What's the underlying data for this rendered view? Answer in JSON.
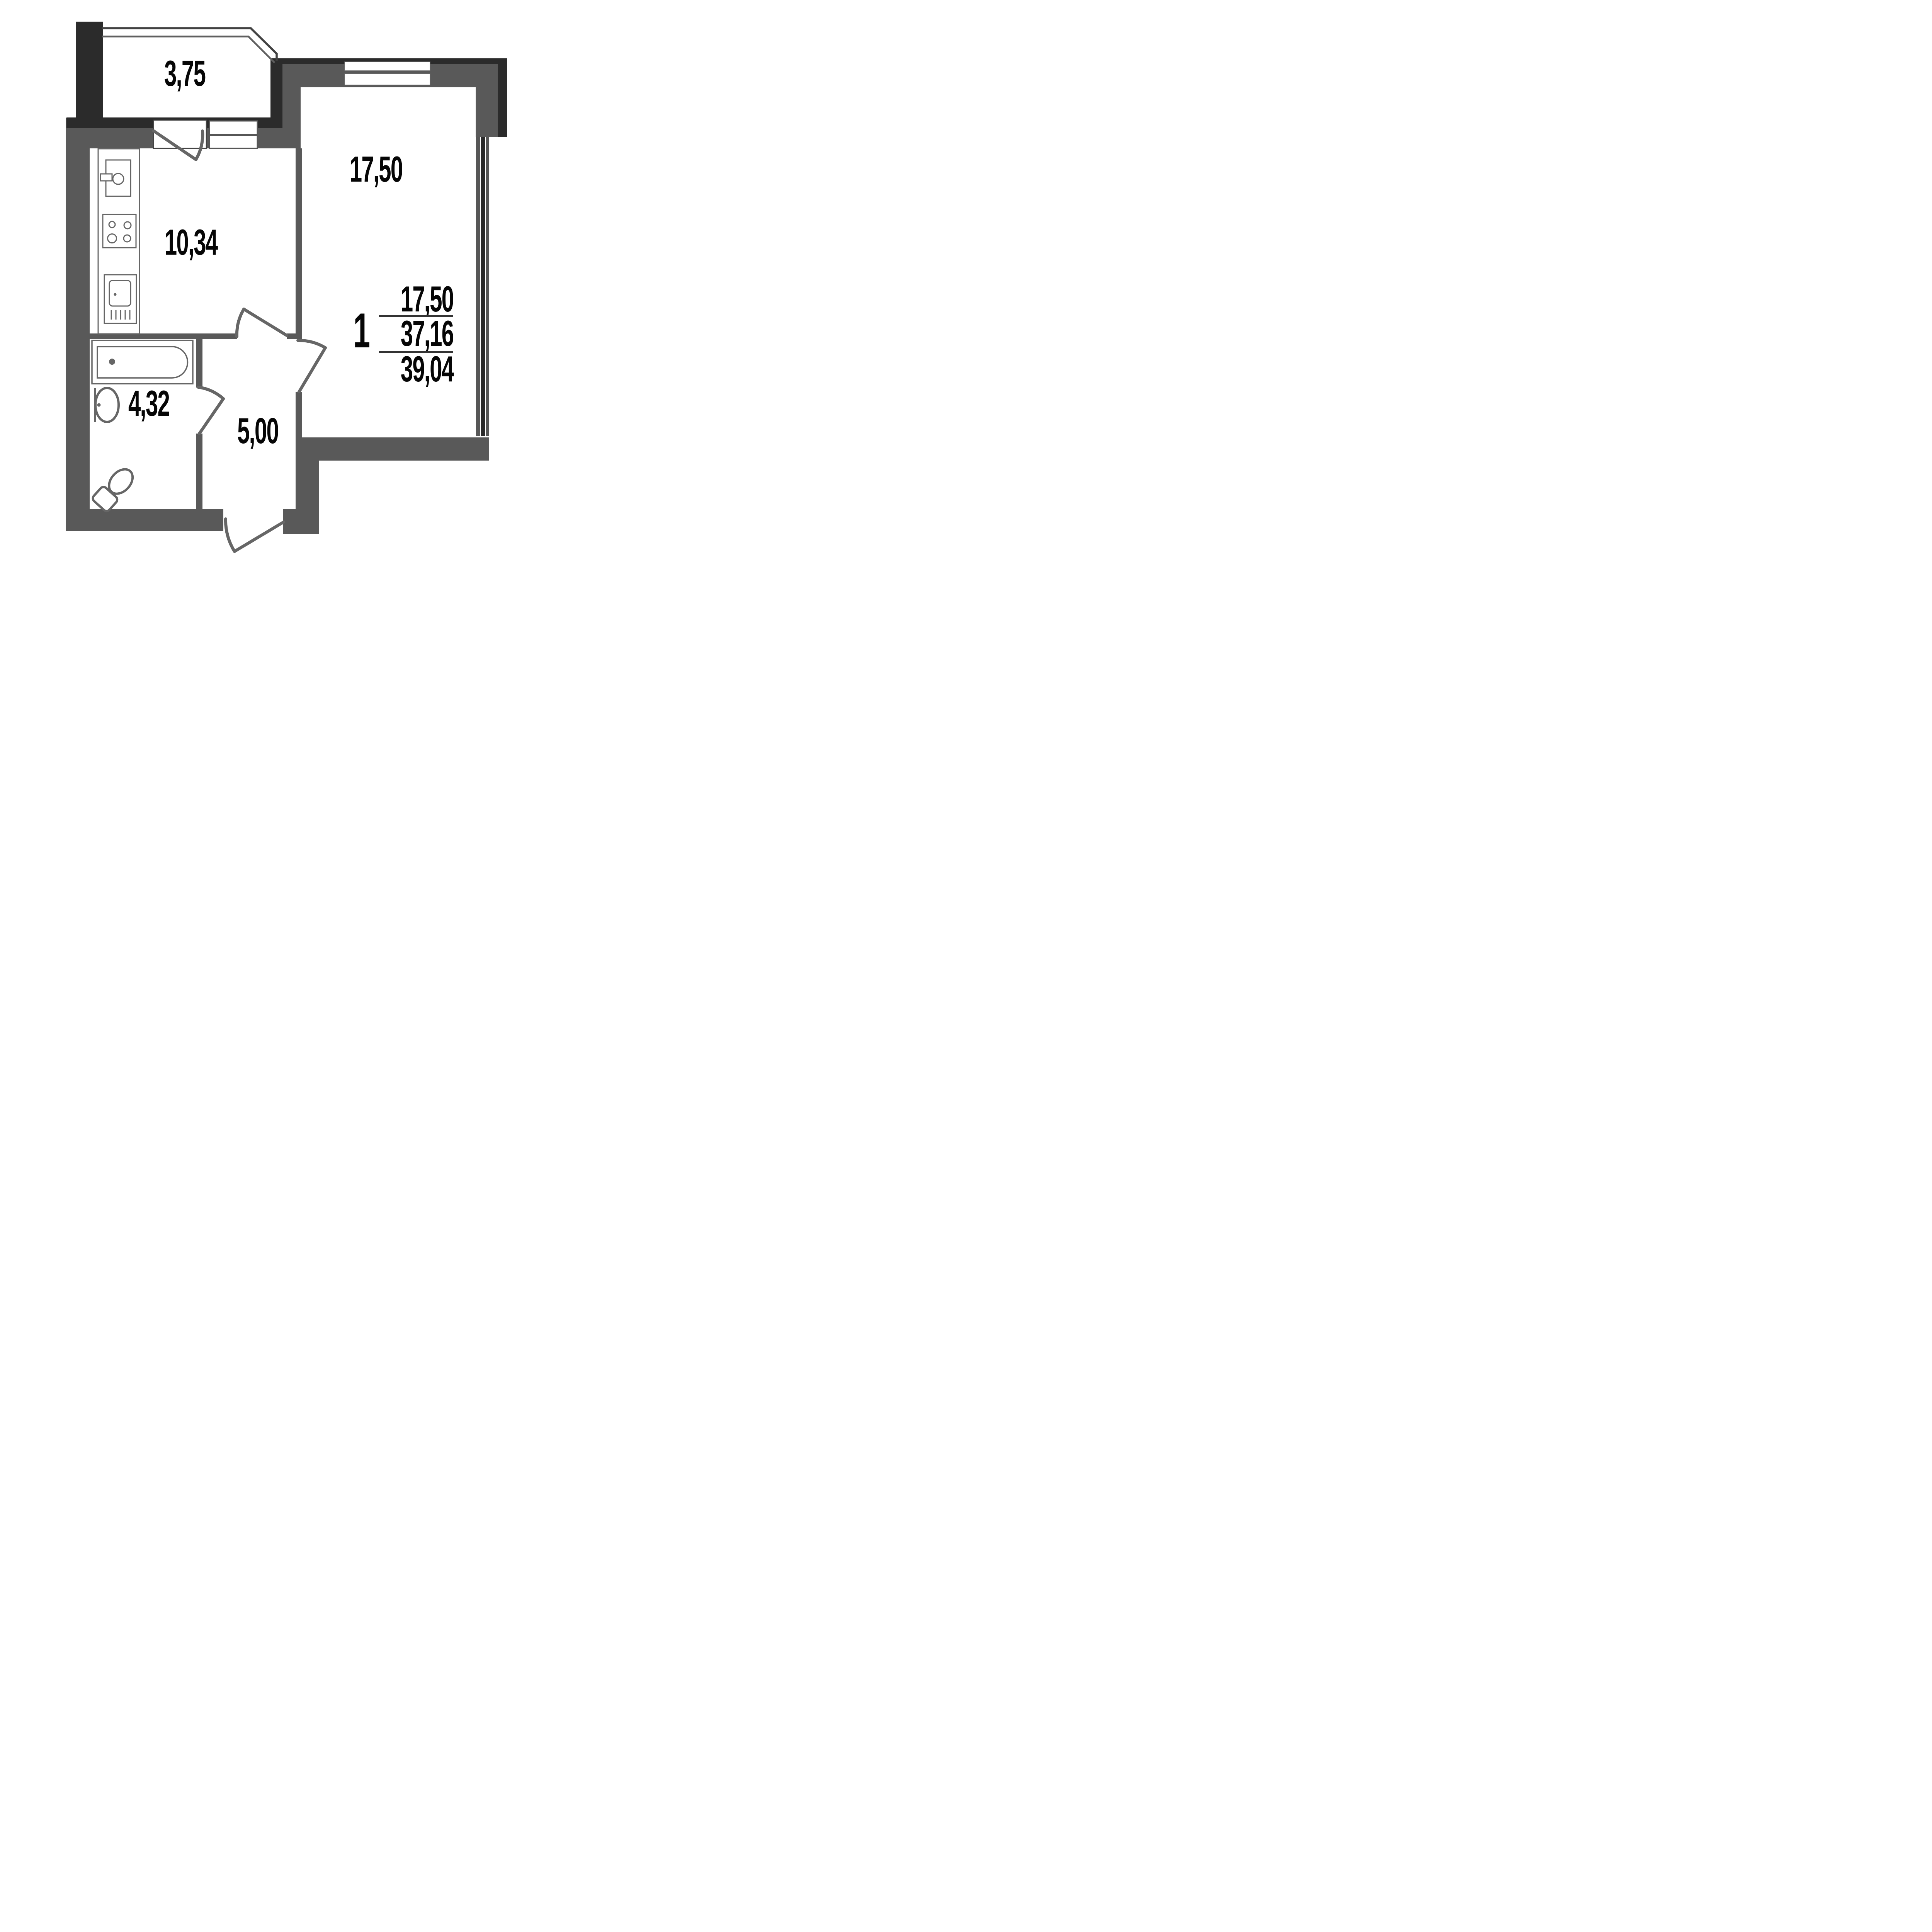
{
  "plan_type": "apartment floor plan",
  "rooms": {
    "balcony": {
      "name": "balcony",
      "area": "3,75"
    },
    "kitchen": {
      "name": "kitchen",
      "area": "10,34"
    },
    "living_room": {
      "name": "living room",
      "area": "17,50"
    },
    "bathroom": {
      "name": "bathroom",
      "area": "4,32"
    },
    "hallway": {
      "name": "hallway",
      "area": "5,00"
    }
  },
  "summary": {
    "rooms_count": "1",
    "living_area": "17,50",
    "apartment_area": "37,16",
    "total_area": "39,04"
  },
  "colors": {
    "wall_dark": "#2b2b2b",
    "wall_gray": "#595959",
    "line_gray": "#666666",
    "text": "#060606",
    "background": "#ffffff"
  },
  "fixtures": [
    "kitchen-counter",
    "kitchen-sink",
    "stove",
    "washing-machine",
    "bathtub",
    "washbasin",
    "toilet",
    "balcony-door",
    "balcony-window",
    "living-room-window",
    "side-window",
    "kitchen-door",
    "living-room-door",
    "bathroom-door",
    "entrance-door"
  ]
}
